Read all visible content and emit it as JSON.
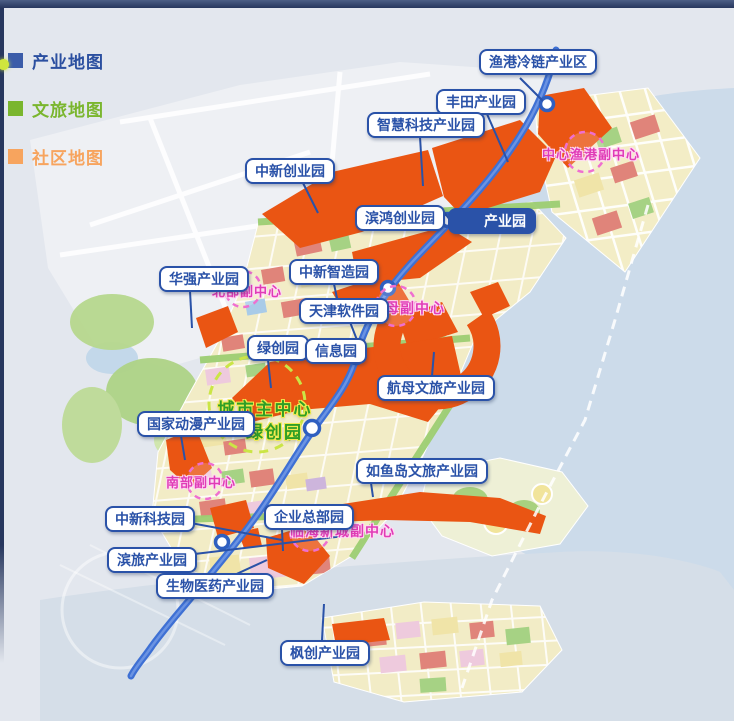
{
  "legend": {
    "items": [
      {
        "id": "industry",
        "label": "产业地图",
        "swatch_color": "#3b5ca9",
        "text_color": "#2b4fa0"
      },
      {
        "id": "culture",
        "label": "文旅地图",
        "swatch_color": "#7ab62e",
        "text_color": "#7ab62e"
      },
      {
        "id": "community",
        "label": "社区地图",
        "swatch_color": "#f7a45e",
        "text_color": "#f7a45e"
      }
    ]
  },
  "map": {
    "park_labels": [
      {
        "text": "渔港冷链产业区"
      },
      {
        "text": "丰田产业园"
      },
      {
        "text": "智慧科技产业园"
      },
      {
        "text": "中新创业园"
      },
      {
        "text": "滨鸿创业园"
      },
      {
        "text": "产业园"
      },
      {
        "text": "中新智造园"
      },
      {
        "text": "华强产业园"
      },
      {
        "text": "天津软件园"
      },
      {
        "text": "绿创园"
      },
      {
        "text": "信息园"
      },
      {
        "text": "航母文旅产业园"
      },
      {
        "text": "国家动漫产业园"
      },
      {
        "text": "如鱼岛文旅产业园"
      },
      {
        "text": "中新科技园"
      },
      {
        "text": "企业总部园"
      },
      {
        "text": "滨旅产业园"
      },
      {
        "text": "生物医药产业园"
      },
      {
        "text": "枫创产业园"
      }
    ],
    "subcenters": [
      {
        "text": "中心渔港副中心"
      },
      {
        "text": "北部副中心"
      },
      {
        "text": "航母副中心"
      },
      {
        "text": "南部副中心"
      },
      {
        "text": "临海新城副中心"
      }
    ],
    "main_center": {
      "line1": "城市主中心",
      "line2": "—绿创园"
    },
    "colors": {
      "industrial_zone_orange": "#ea5513",
      "route_blue": "#3e70d4",
      "label_blue": "#2a52a8",
      "subcenter_pink": "#e03cb6",
      "main_center_green": "#2f9e26",
      "water": "#ccdbea",
      "urban_block_yellow": "#f2ecc6",
      "green_corridor": "#9ccd72"
    }
  }
}
